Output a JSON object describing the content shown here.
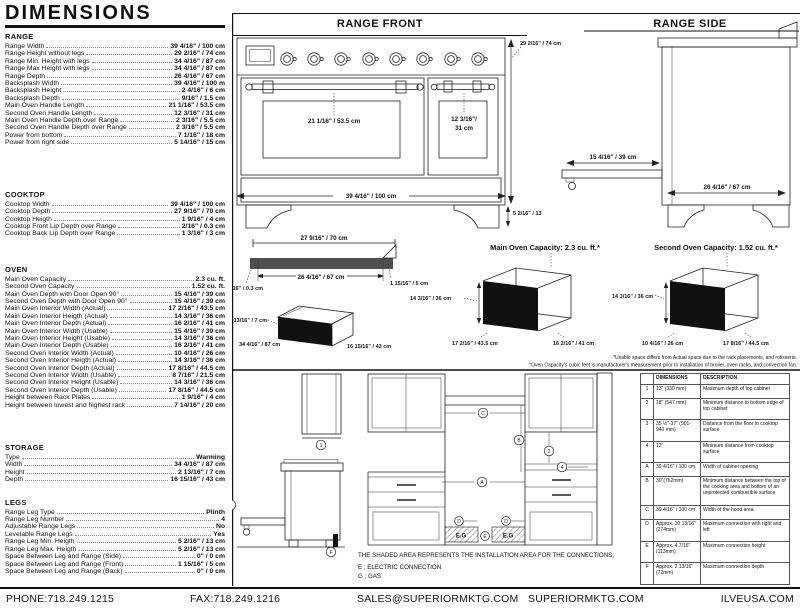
{
  "title": "DIMENSIONS",
  "specs": [
    {
      "heading": "RANGE",
      "rows": [
        {
          "label": "Range Width",
          "value": "39 4/16\" / 100 cm"
        },
        {
          "label": "Range Height without legs",
          "value": "29 2/16\" / 74 cm"
        },
        {
          "label": "Range Min. Height with legs",
          "value": "34 4/16\" / 87 cm"
        },
        {
          "label": "Range Max Height with legs",
          "value": "34 4/16\" / 87 cm"
        },
        {
          "label": "Range Depth",
          "value": "26 4/16\" / 67 cm"
        },
        {
          "label": "Backsplash Width",
          "value": "39 4/16\" / 100 m"
        },
        {
          "label": "Backsplash Height",
          "value": "2 4/16\" / 6 cm"
        },
        {
          "label": "Backsplash Depth",
          "value": "9/16\" / 1.5 cm"
        },
        {
          "label": "Main Oven Handle Length",
          "value": "21 1/16\" / 53.5 cm"
        },
        {
          "label": "Second Oven Handle Length",
          "value": "12 3/16\" / 31 cm"
        },
        {
          "label": "Main Oven Handle Depth over Range",
          "value": "2 3/16\" / 5.5 cm"
        },
        {
          "label": "Second Oven Handle Depth over Range",
          "value": "2 3/16\" / 5.5 cm"
        },
        {
          "label": "Power from bottom",
          "value": "7 1/16\" / 18 cm"
        },
        {
          "label": "Power from right side",
          "value": "5 14/16\" / 15 cm"
        }
      ]
    },
    {
      "heading": "COOKTOP",
      "rows": [
        {
          "label": "Cooktop Width",
          "value": "39 4/16\" / 100 cm"
        },
        {
          "label": "Cooktop Depth",
          "value": "27 9/16\" / 70 cm"
        },
        {
          "label": "Cooktop Heigth",
          "value": "1 9/16\" / 4 cm"
        },
        {
          "label": "Cooktop Front Lip Depth over Range",
          "value": "2/16\" / 0.3 cm"
        },
        {
          "label": "Cooktop Back Lip Depth over Range",
          "value": "1 3/16\" / 3 cm"
        }
      ]
    },
    {
      "heading": "OVEN",
      "rows": [
        {
          "label": "Main Oven Capacity",
          "value": "2.3 cu. ft."
        },
        {
          "label": "Second Oven Capacity",
          "value": "1.52 cu. ft."
        },
        {
          "label": "Main Oven Depth with Door Open 90°",
          "value": "15 4/16\" / 39 cm"
        },
        {
          "label": "Second Oven Depth with Door Open 90°",
          "value": "15 4/16\" / 39 cm"
        },
        {
          "label": "Main Oven Interior Width (Actual)",
          "value": "17 2/16\" / 43.5 cm"
        },
        {
          "label": "Main Oven Interior Heigth (Actual)",
          "value": "14 3/16\" / 36 cm"
        },
        {
          "label": "Main Oven Interior Depth (Actual)",
          "value": "16 2/16\" / 41 cm"
        },
        {
          "label": "Main Oven Interior Width (Usable)",
          "value": "15 4/16\" / 39 cm"
        },
        {
          "label": "Main Oven Interior Height (Usable)",
          "value": "14 3/16\" / 36 cm"
        },
        {
          "label": "Main Oven Interior Depth (Usable)",
          "value": "16 2/16\" / 41 cm"
        },
        {
          "label": "Second Oven Interior Width (Actual)",
          "value": "10 4/16\" / 26 cm"
        },
        {
          "label": "Second Oven Interior Heigth (Actual)",
          "value": "14 3/16\" / 36 cm"
        },
        {
          "label": "Second Oven Interior Depth (Actual)",
          "value": "17 8/16\" / 44.5 cm"
        },
        {
          "label": "Second Oven Interior Width (Usable)",
          "value": "8 7/16\" / 21.5 cm"
        },
        {
          "label": "Second Oven Interior Height (Usable)",
          "value": "14 3/16\" / 36 cm"
        },
        {
          "label": "Second Oven Interior Depth (Usable)",
          "value": "17 8/16\" / 44.5 cm"
        },
        {
          "label": "Height between Rack Plates",
          "value": "1 9/16\" / 4 cm"
        },
        {
          "label": "Height between lowest and highest rack",
          "value": "7 14/16\" / 20 cm"
        }
      ]
    },
    {
      "heading": "STORAGE",
      "rows": [
        {
          "label": "Type",
          "value": "Warming"
        },
        {
          "label": "Width",
          "value": "34 4/16\" / 87 cm"
        },
        {
          "label": "Height",
          "value": "2 13/16\" / 7 cm"
        },
        {
          "label": "Depth",
          "value": "16 15/16\" / 43 cm"
        }
      ]
    },
    {
      "heading": "LEGS",
      "rows": [
        {
          "label": "Range Leg Type",
          "value": "Plinth"
        },
        {
          "label": "Range Leg Number",
          "value": "4"
        },
        {
          "label": "Adjustable Range Legs",
          "value": "No"
        },
        {
          "label": "Levelable Range Legs",
          "value": "Yes"
        },
        {
          "label": "Range Leg Min. Heigth",
          "value": "5 2/16\" / 13 cm"
        },
        {
          "label": "Range Leg Max. Heigth",
          "value": "5 2/16\" / 13 cm"
        },
        {
          "label": "Space Between Leg and Range (Side)",
          "value": "0\" / 0 cm"
        },
        {
          "label": "Space Between Leg and Range (Front)",
          "value": "1 15/16\" / 5 cm"
        },
        {
          "label": "Space Between Leg and Range (Back)",
          "value": "0\" / 0 cm"
        }
      ]
    }
  ],
  "range_front": {
    "title": "RANGE FRONT",
    "main_handle_label": "21 1/16\" / 53.5 cm",
    "second_handle_line1": "12 3/16\"/",
    "second_handle_line2": "31 cm",
    "width_label": "39 4/16\" / 100 cm",
    "height_label": "29 2/16\" / 74 cm",
    "leg_label": "5 2/16\" / 13"
  },
  "range_side": {
    "title": "RANGE SIDE",
    "door_label": "15 4/16\" / 39 cm",
    "depth_label": "26 4/16\" / 67 cm"
  },
  "cooktop_top": {
    "outer_label": "27 9/16\" / 70 cm",
    "inner_label": "26 4/16\" / 67 cm",
    "left_label": "2/16\" / 0.3 cm",
    "right_label": "1 15/16\" / 5 cm"
  },
  "storage_drawer": {
    "height_label": "2 13/16\" / 7 cm",
    "width_label": "34 4/16\" / 87 cm",
    "depth_label": "16 15/16\" / 43 cm"
  },
  "main_oven_diag": {
    "title": "Main Oven Capacity: 2.3 cu. ft.*",
    "height_label": "14 3/16\" / 36 cm",
    "width_label": "17 2/16\" / 43.5 cm",
    "depth_label": "16 2/16\" / 41 cm"
  },
  "second_oven_diag": {
    "title": "Second Oven Capacity: 1.52 cu. ft.*",
    "height_label": "14 3/16\" / 36 cm",
    "width_label": "10 4/16\" / 26 cm",
    "depth_label": "17 8/16\" / 44.5 cm"
  },
  "footnotes": {
    "line1": "*Usable space differs from Actual space due to the rack placements, and rotisserie.",
    "line2": "*Oven Capacity's cubic feet is manufacturer's measurement prior to installation of broiler, oven racks, and convection fan."
  },
  "install": {
    "note": "THE SHADED AREA REPRESENTS THE INSTALLATION AREA FOR THE CONNECTIONS;",
    "electric": "E ; ELECTRIC CONNECTION",
    "gas": "G ; GAS",
    "eg_label": "E.G",
    "markers": [
      "1",
      "2",
      "3",
      "4",
      "A",
      "B",
      "C",
      "D",
      "E",
      "F"
    ]
  },
  "dim_table": {
    "headers": [
      "",
      "DIMENSIONS",
      "DESCRIPTION"
    ],
    "rows": [
      [
        "1",
        "13\" (330 mm)",
        "Maximum depth of top cabinet"
      ],
      [
        "2",
        "18\" (547 mm)",
        "Minimum distance to bottom edge of top cabinet"
      ],
      [
        "3",
        "35 ½\"-37\" (901-940 mm)",
        "Distance from the floor to cooktop surface"
      ],
      [
        "4",
        "12\"",
        "Minimum distance from cooktop surface"
      ],
      [
        "A",
        "39 4/16\" / 100 cm",
        "Width of cabinet opening"
      ],
      [
        "B",
        "30\"(762mm)",
        "Minimum distance between the top of the cooking area and bottom of an unprotected combustible surface"
      ],
      [
        "C",
        "39 4/16\" / 100 cm",
        "Width of the hood area"
      ],
      [
        "D",
        "Approx. 10 13/16\" (274mm)",
        "Maximum connection with right and left"
      ],
      [
        "E",
        "Approx. 4 7/16\" (113mm)",
        "Maximum connection height"
      ],
      [
        "F",
        "Approx. 2 13/16\" (72mm)",
        "Maximum connection depth"
      ]
    ]
  },
  "footer": {
    "phone": "PHONE:718.249.1215",
    "fax": "FAX:718.249.1216",
    "email": "SALES@SUPERIORMKTG.COM",
    "site1": "SUPERIORMKTG.COM",
    "site2": "ILVEUSA.COM"
  }
}
